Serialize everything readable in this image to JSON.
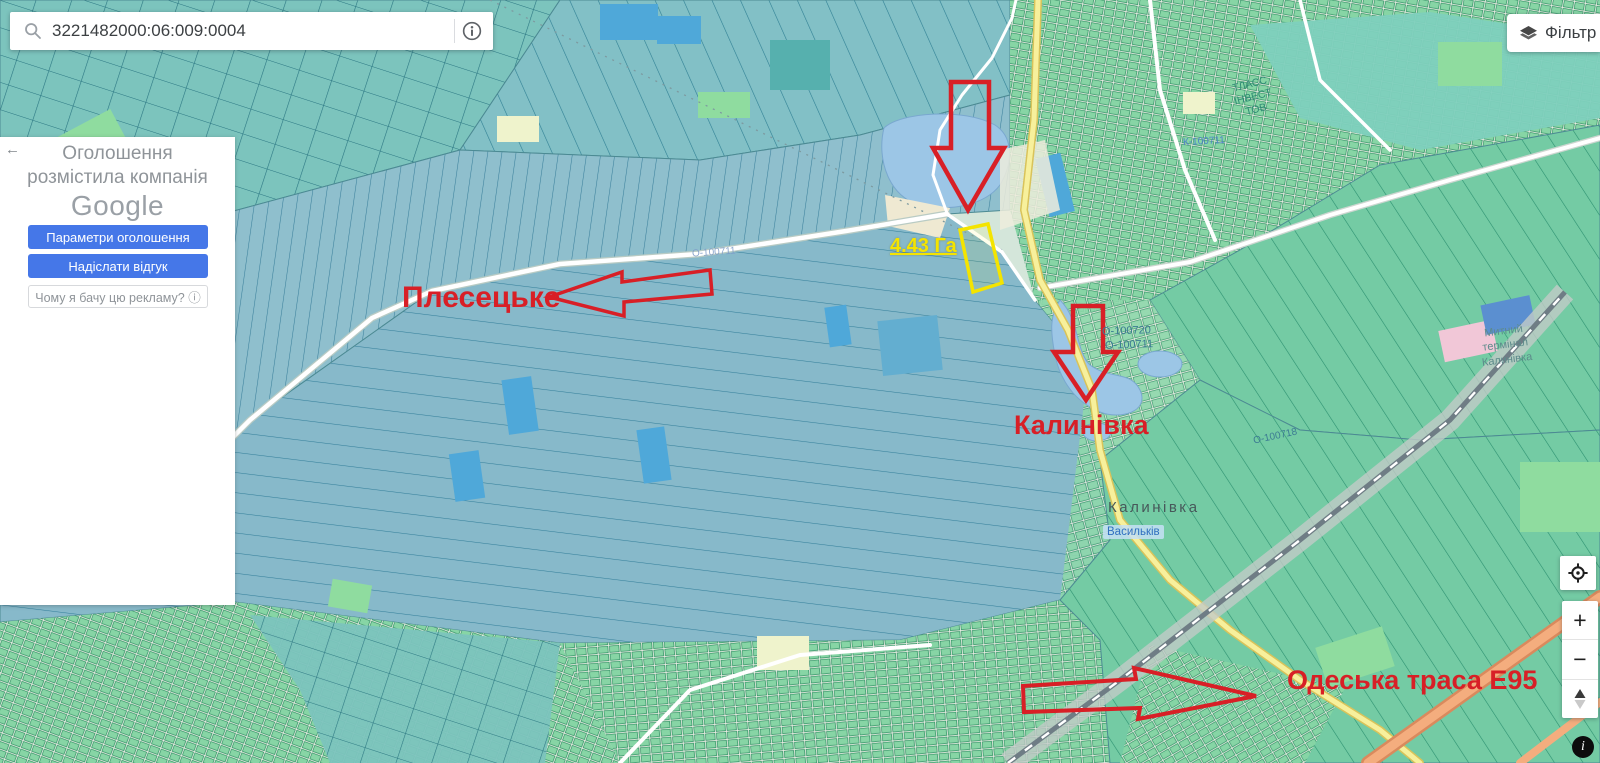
{
  "colors": {
    "annotation_red": "#d81f26",
    "parcel_yellow": "#f4e400",
    "primary_blue": "#4577e8"
  },
  "search_bar": {
    "value": "3221482000:06:009:0004"
  },
  "filter_button": {
    "label": "Фільтр"
  },
  "ad_panel": {
    "back_icon": "←",
    "line1": "Оголошення",
    "line2": "розмістила компанія",
    "brand": "Google",
    "settings_button": "Параметри оголошення",
    "feedback_button": "Надіслати відгук",
    "why_button": "Чому я бачу цю рекламу? ⓘ"
  },
  "map_controls": {
    "zoom_in": "+",
    "zoom_out": "−",
    "info": "i"
  },
  "annotations": {
    "plesetske": "Плесецьке",
    "kalynivka": "Калинівка",
    "highway": "Одеська траса Е95",
    "parcel_area": "4.43 Га"
  },
  "map_labels": {
    "road_o100711_west": "О-100711",
    "road_o100720": "О-100720",
    "road_o100711_east": "О-100711",
    "road_o100718": "О-100718",
    "road_k100711": "К-100711",
    "town": "Калинівка",
    "district": "Васильків",
    "company": "ТЛАСС\nІНВЕСТ\nТОВ",
    "terminal": "Митний\nтермінал\nКалинівка"
  }
}
